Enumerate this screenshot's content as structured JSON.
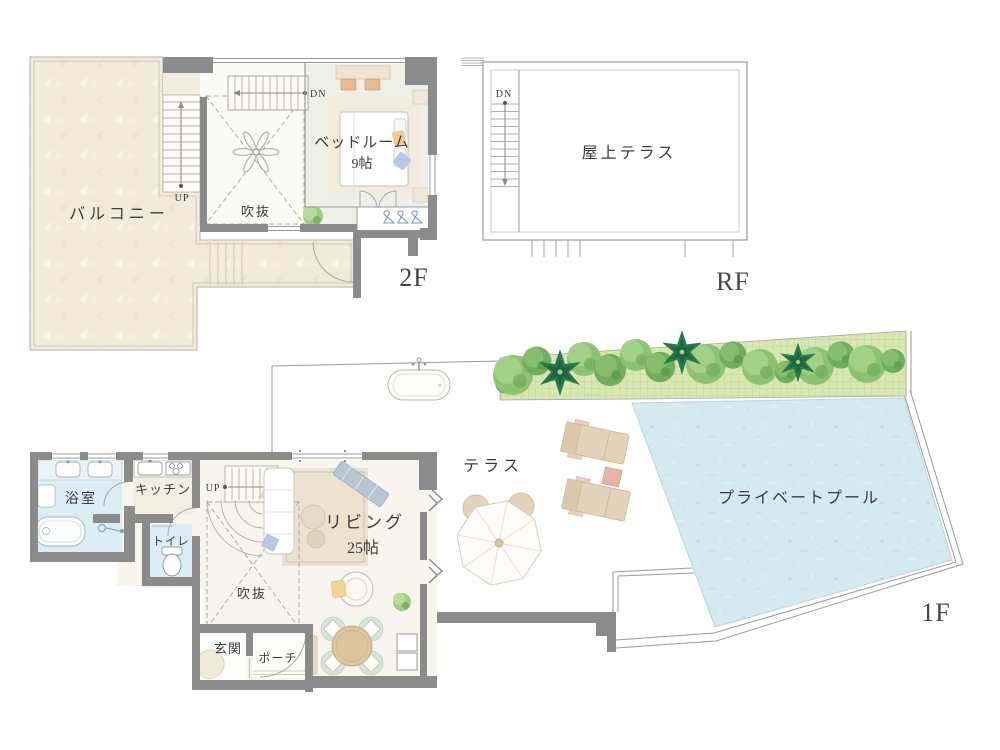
{
  "document": {
    "type": "residence-floor-plan"
  },
  "floors": {
    "f2": {
      "tag": "2F",
      "rooms": {
        "balcony": "バルコニー",
        "void": "吹抜",
        "bedroom": "ベッドルーム",
        "bedroom_size": "9帖"
      },
      "stairs": {
        "up": "UP",
        "down": "DN"
      }
    },
    "rf": {
      "tag": "RF",
      "rooms": {
        "roof_terrace": "屋上テラス"
      },
      "stairs": {
        "down": "DN"
      }
    },
    "f1": {
      "tag": "1F",
      "rooms": {
        "bathroom": "浴室",
        "kitchen": "キッチン",
        "toilet": "トイレ",
        "living": "リビング",
        "living_size": "25帖",
        "void": "吹抜",
        "entrance": "玄関",
        "porch": "ポーチ",
        "terrace": "テラス",
        "pool": "プライベートプール"
      },
      "stairs": {
        "up": "UP"
      }
    }
  },
  "colors": {
    "wall": "#8b8b8b",
    "balcony": "#f3ebd9",
    "water": "#d4eaf1",
    "bath": "#dcedf3",
    "floor": "#f7f5ee",
    "grass": "#d9e7b2",
    "greenery": "#8cc373",
    "wood": "#e5d3b9",
    "text": "#3c3c3c"
  }
}
